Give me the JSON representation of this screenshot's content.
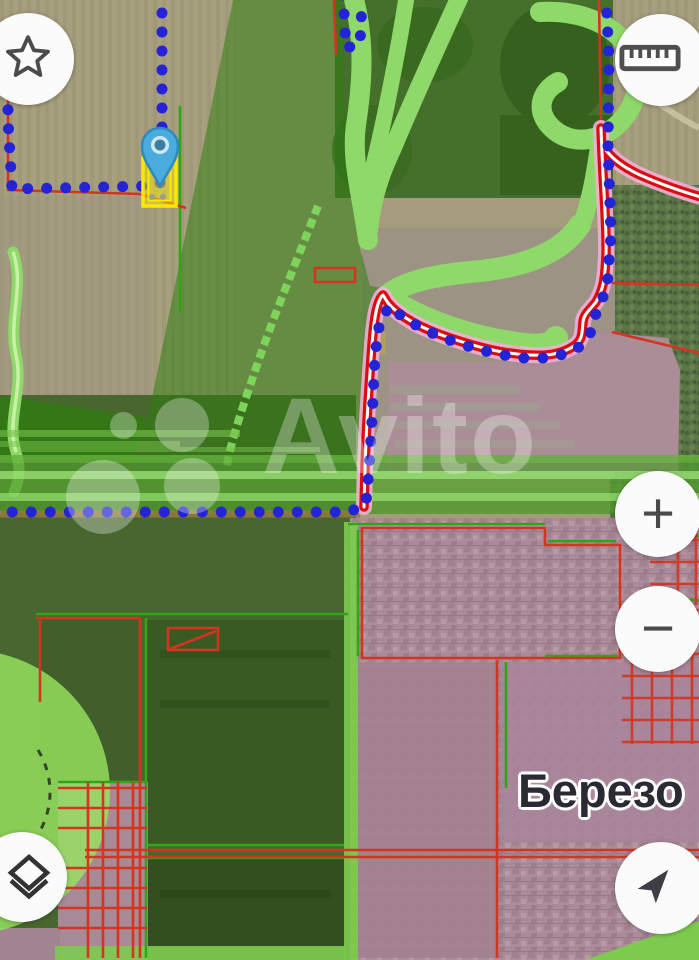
{
  "app": {
    "watermark_brand": "Avito"
  },
  "map": {
    "type": "satellite-cadastral-map",
    "place_label": "Березо",
    "watermark_text": "Avito",
    "selected_parcel": {
      "highlight": "yellow-outline",
      "marker": "map-pin"
    }
  },
  "controls": {
    "favorite": {
      "icon": "star-icon"
    },
    "measure": {
      "icon": "ruler-icon"
    },
    "zoom_in": {
      "label": "+"
    },
    "zoom_out": {
      "label": "−"
    },
    "layers": {
      "icon": "layers-icon"
    },
    "locate": {
      "icon": "navigation-arrow-icon"
    }
  },
  "colors": {
    "dot_blue": "#2424d6",
    "route_red": "#d80f0f",
    "route_halo_pink": "#f2aed6",
    "cadastral_red": "#d43420",
    "cadastral_green": "#2fa616",
    "overlay_green": "#2e7d0f",
    "light_green": "#8fd96b",
    "parcel_yellow": "#ffe800",
    "pin_blue": "#4aabdc",
    "urban_mauve": "#ac8b98",
    "watermark_white": "#ffffff"
  }
}
